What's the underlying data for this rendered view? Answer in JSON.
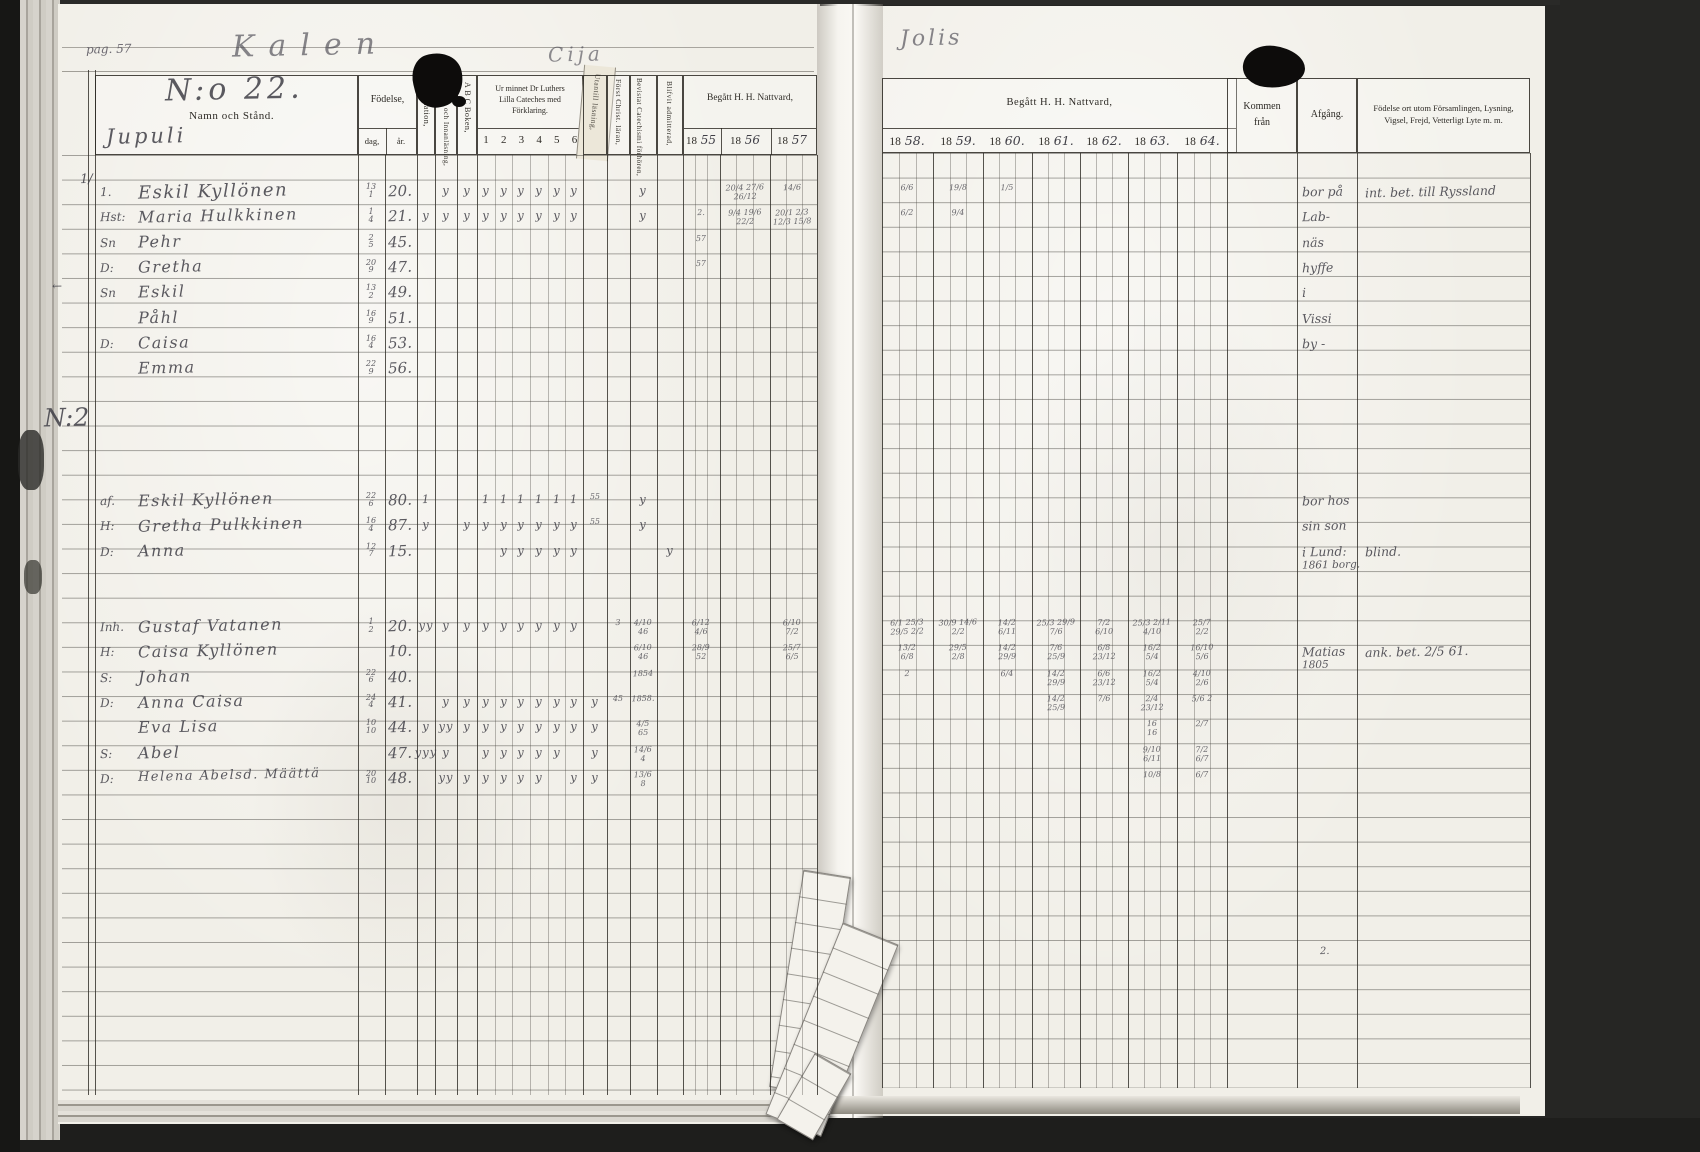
{
  "page_meta": {
    "pag_label": "pag. 57",
    "title_left": "Kalen",
    "title_mid": "Cija",
    "title_right": "Jolis",
    "household_no": "N:o 22.",
    "village": "Jupuli",
    "year_prefix": "18"
  },
  "left_header": {
    "name_label": "Namn och Stånd.",
    "birth_label": "Födelse,",
    "birth_day": "dag,",
    "birth_year": "år.",
    "vaccination": "Vaccination,",
    "reading": "Stafning och Innanläsning,",
    "abc": "A B C Boken,",
    "cat_line1": "Ur minnet Dr Luthers",
    "cat_line2": "Lilla Cateches med",
    "cat_line3": "Förklaring.",
    "cat_cols": [
      "1",
      "2",
      "3",
      "4",
      "5",
      "6"
    ],
    "memory": "Utantill läsning,",
    "first_christ": "Först Christ. läran,",
    "attended": "Bevistat Catechismi förhören,",
    "admitted": "Blifvit admitterad,",
    "communion_label": "Begått H. H. Nattvard,",
    "year_suffixes": [
      "55",
      "56",
      "57"
    ]
  },
  "right_header": {
    "communion_label": "Begått H. H. Nattvard,",
    "year_suffixes": [
      "58.",
      "59.",
      "60.",
      "61.",
      "62.",
      "63.",
      "64."
    ],
    "kommen_line1": "Kommen",
    "kommen_line2": "från",
    "afgang_label": "Afgång.",
    "notes_line1": "Födelse ort utom Församlingen, Lysning,",
    "notes_line2": "Vigsel, Frejd, Vetterligt Lyte m. m."
  },
  "groups": [
    {
      "rows": [
        {
          "pfx": "1.",
          "name": "Eskil Kyllönen",
          "day": "13/1",
          "yr": "20.",
          "size": 18,
          "marks": {
            "staf": "y",
            "abc": "y",
            "c1": "y",
            "c2": "y",
            "c3": "y",
            "c4": "y",
            "c5": "y",
            "c6": "y",
            "bev": "y",
            "n56": "20/4 27/6|26/12",
            "n57": "14/6",
            "r58": "6/6",
            "r59": "19/8",
            "r60": "1/5"
          },
          "afg": "bor på",
          "note": "int. bet. till Ryssland"
        },
        {
          "pfx": "Hst:",
          "name": "Maria Hulkkinen",
          "day": "1/4",
          "yr": "21.",
          "marks": {
            "vacc": "y",
            "staf": "y",
            "abc": "y",
            "c1": "y",
            "c2": "y",
            "c3": "y",
            "c4": "y",
            "c5": "y",
            "c6": "y",
            "bev": "y",
            "n55": "2.",
            "n56": "9/4 19/6|22/2",
            "n57": "20/1 2/3|12/3 15/8",
            "r58": "6/2",
            "r59": "9/4"
          },
          "afg": "Lab-"
        },
        {
          "pfx": "Sn",
          "name": "Pehr",
          "day": "2/5",
          "yr": "45.",
          "marks": {
            "n55": "57"
          },
          "afg": "näs"
        },
        {
          "pfx": "D:",
          "name": "Gretha",
          "day": "20/9",
          "yr": "47.",
          "marks": {
            "n55": "57"
          },
          "afg": "hyffe"
        },
        {
          "pfx": "Sn",
          "name": "Eskil",
          "day": "13/2",
          "yr": "49.",
          "marks": {},
          "afg": "i"
        },
        {
          "pfx": "",
          "name": "Påhl",
          "day": "16/9",
          "yr": "51.",
          "marks": {},
          "afg": "Vissi"
        },
        {
          "pfx": "D:",
          "name": "Caisa",
          "day": "16/4",
          "yr": "53.",
          "marks": {},
          "afg": "by -"
        },
        {
          "pfx": "",
          "name": "Emma",
          "day": "22/9",
          "yr": "56.",
          "marks": {}
        }
      ]
    },
    {
      "rows": [
        {
          "pfx": "af.",
          "name": "Eskil Kyllönen",
          "day": "22/6",
          "yr": "80.",
          "marks": {
            "vacc": "1",
            "c1": "1",
            "c2": "1",
            "c3": "1",
            "c4": "1",
            "c5": "1",
            "c6": "1",
            "slip": "55",
            "bev": "y"
          },
          "afg": "bor hos"
        },
        {
          "pfx": "H:",
          "name": "Gretha Pulkkinen",
          "day": "16/4",
          "yr": "87.",
          "marks": {
            "vacc": "y",
            "abc": "y",
            "c1": "y",
            "c2": "y",
            "c3": "y",
            "c4": "y",
            "c5": "y",
            "c6": "y",
            "slip": "55",
            "bev": "y"
          },
          "afg": "sin son"
        },
        {
          "pfx": "D:",
          "name": "Anna",
          "day": "12/7",
          "yr": "15.",
          "marks": {
            "c2": "y",
            "c3": "y",
            "c4": "y",
            "c5": "y",
            "c6": "y",
            "adm": "y"
          },
          "afg": "i Lund:",
          "afg2": "1861 borg.",
          "note": "blind."
        }
      ]
    },
    {
      "rows": [
        {
          "pfx": "Inh.",
          "name": "Gustaf Vatanen",
          "day": "1/2",
          "yr": "20.",
          "marks": {
            "vacc": "yy",
            "staf": "y",
            "abc": "y",
            "c1": "y",
            "c2": "y",
            "c3": "y",
            "c4": "y",
            "c5": "y",
            "c6": "y",
            "fc": "3",
            "bev": "4/10|46",
            "n55": "6/12|4/6",
            "n57": "6/10|7/2",
            "r58": "6/1 25/3|29/5 2/2",
            "r59": "30/9 14/6|2/2",
            "r60": "14/2|6/11",
            "r61": "25/3 29/9|7/6",
            "r62": "7/2|6/10",
            "r63": "25/3 2/11|4/10",
            "r64": "25/7|2/2"
          }
        },
        {
          "pfx": "H:",
          "name": "Caisa Kyllönen",
          "day": "",
          "yr": "10.",
          "marks": {
            "bev": "6/10|46",
            "n55": "28/9|52",
            "n57": "25/7|6/5",
            "r58": "13/2|6/8",
            "r59": "29/5|2/8",
            "r60": "14/2|29/9",
            "r61": "7/6|25/9",
            "r62": "6/8|23/12",
            "r63": "16/2|5/4",
            "r64": "16/10|5/6"
          },
          "afg": "Matias",
          "afg2": "1805",
          "note": "ank. bet. 2/5 61."
        },
        {
          "pfx": "S:",
          "name": "Johan",
          "day": "22/6",
          "yr": "40.",
          "marks": {
            "bev": "1854",
            "r58": "2",
            "r60": "6/4",
            "r61": "14/2|29/9",
            "r62": "6/6|23/12",
            "r63": "16/2|5/4",
            "r64": "4/10|2/6"
          }
        },
        {
          "pfx": "D:",
          "name": "Anna Caisa",
          "day": "24/4",
          "yr": "41.",
          "marks": {
            "staf": "y",
            "abc": "y",
            "c1": "y",
            "c2": "y",
            "c3": "y",
            "c4": "y",
            "c5": "y",
            "c6": "y",
            "slip": "y",
            "fc": "45",
            "bev": "1858.",
            "r61": "14/2|25/9",
            "r62": "7/6",
            "r63": "2/4|23/12",
            "r64": "5/6 2"
          }
        },
        {
          "pfx": "",
          "name": "Eva Lisa",
          "day": "10/10",
          "yr": "44.",
          "marks": {
            "vacc": "y",
            "staf": "yy",
            "abc": "y",
            "c1": "y",
            "c2": "y",
            "c3": "y",
            "c4": "y",
            "c5": "y",
            "c6": "y",
            "slip": "y",
            "bev": "4/5|65",
            "r63": "16|16",
            "r64": "2/7"
          }
        },
        {
          "pfx": "S:",
          "name": "Abel",
          "day": "",
          "yr": "47.",
          "marks": {
            "vacc": "yyy",
            "staf": "y",
            "c1": "y",
            "c2": "y",
            "c3": "y",
            "c4": "y",
            "c5": "y",
            "slip": "y",
            "bev": "14/6|4",
            "r63": "9/10|6/11",
            "r64": "7/2|6/7"
          }
        },
        {
          "pfx": "D:",
          "name": "Helena Abelsd. Määttä",
          "day": "20/10",
          "yr": "48.",
          "size": 13,
          "marks": {
            "staf": "yy",
            "abc": "y",
            "c1": "y",
            "c2": "y",
            "c3": "y",
            "c4": "y",
            "c6": "y",
            "slip": "y",
            "bev": "13/6|8",
            "r63": "10/8",
            "r64": "6/7"
          }
        }
      ]
    }
  ],
  "margin_marks": [
    {
      "t": "1/",
      "x": 80,
      "y": 180,
      "s": 13
    },
    {
      "t": "←",
      "x": 52,
      "y": 286,
      "s": 12
    },
    {
      "t": "N:2",
      "x": 44,
      "y": 418,
      "s": 25
    },
    {
      "t": "2.",
      "x": 1320,
      "y": 952,
      "s": 10
    }
  ]
}
